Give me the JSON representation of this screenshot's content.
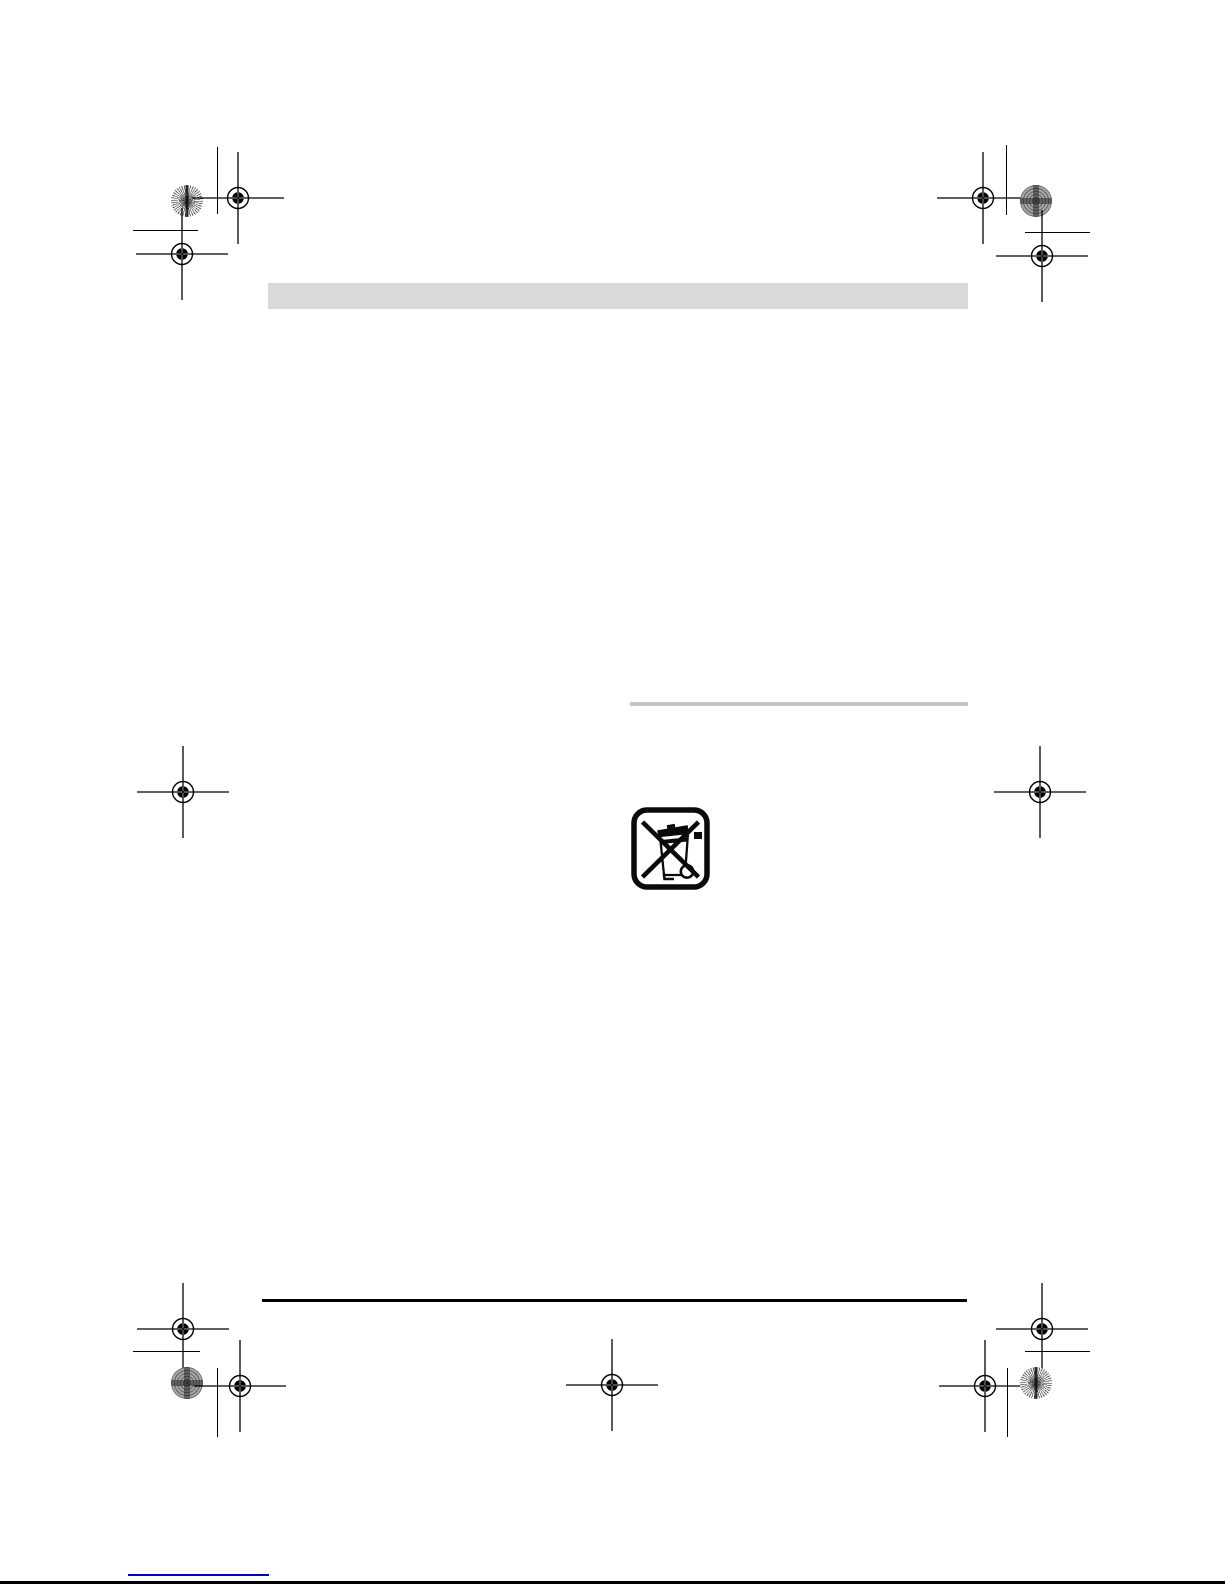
{
  "page": {
    "kind": "pre-press proof page",
    "visible_text": "",
    "notes": "Blank manual page showing only printer crop/registration marks, calibration patches, an empty gray heading bar, a WEEE crossed-out wheeled bin symbol, horizontal rules and a truncated hyperlink underline at the bottom edge."
  },
  "colors": {
    "page_bg": "#ffffff",
    "header_bar": "#d9d9d9",
    "divider": "#c6c6c6",
    "rule": "#000000",
    "mark_ink": "#000000",
    "link": "#0000cc"
  },
  "icons": {
    "weee_bin": "weee-crossed-out-wheelie-bin",
    "registration_mark": "printer-registration-target",
    "starburst_patch": "calibration-starburst-patch",
    "moire_patch": "calibration-moire-patch"
  },
  "footer": {
    "hyperlink_text": ""
  }
}
